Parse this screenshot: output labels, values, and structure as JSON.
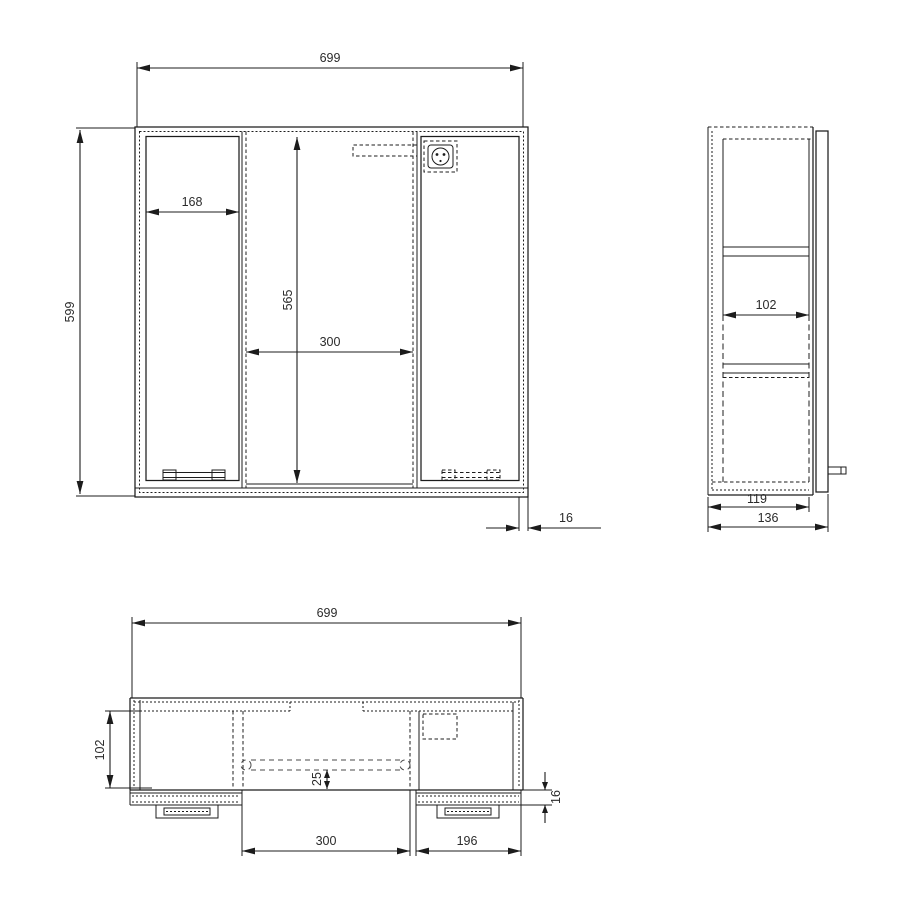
{
  "drawing": {
    "front_view": {
      "overall_width": "699",
      "overall_height": "599",
      "left_door_width": "168",
      "opening_height": "565",
      "opening_width": "300",
      "panel_thickness": "16"
    },
    "side_view": {
      "inner_depth": "102",
      "carcass_depth": "119",
      "overall_depth": "136"
    },
    "bottom_view": {
      "overall_width": "699",
      "inner_depth": "102",
      "door_offset": "25",
      "door_thickness": "16",
      "opening_width": "300",
      "right_door_width": "196"
    }
  },
  "icons": {
    "power_socket": "power-socket"
  },
  "colors": {
    "line": "#1c1c1c",
    "dim_text": "#2b2b2b",
    "background": "#ffffff"
  }
}
